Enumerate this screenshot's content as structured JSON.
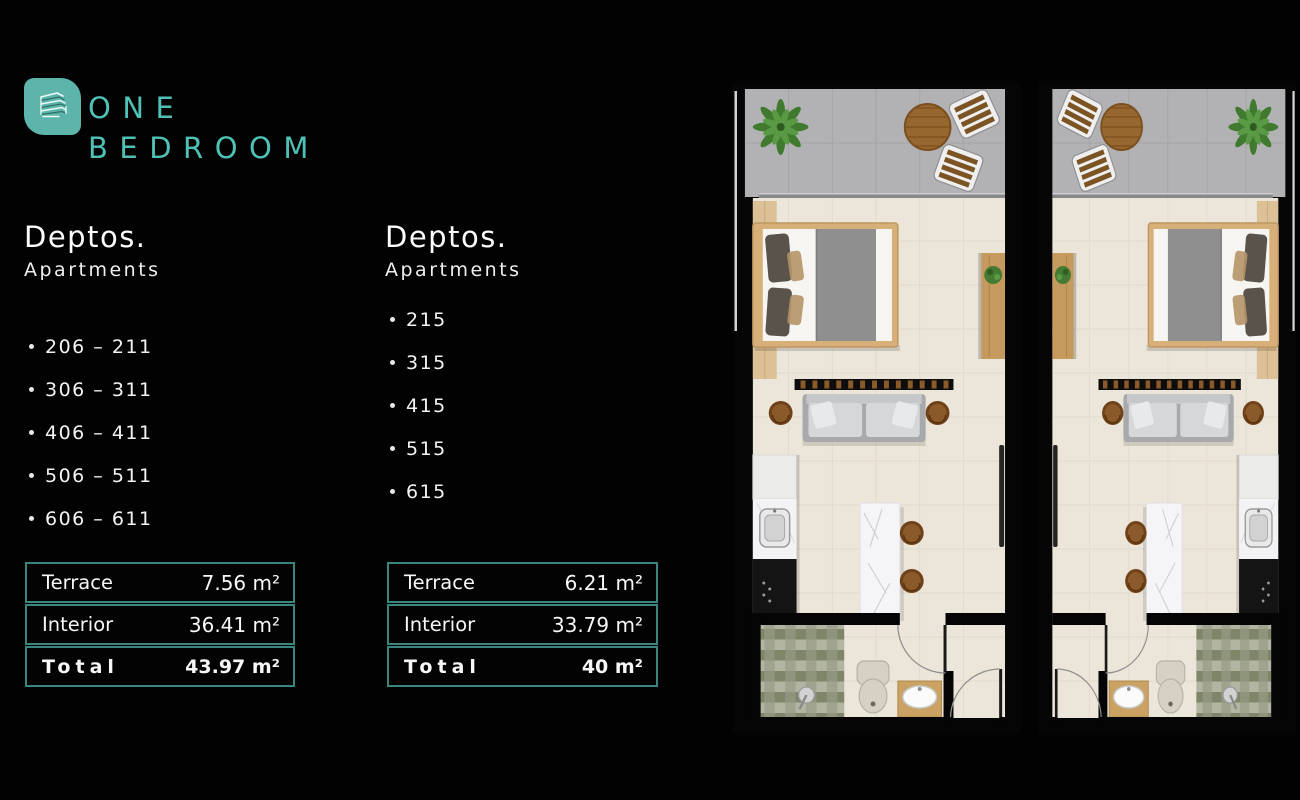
{
  "brand": {
    "logo_icon": "building-icon",
    "title_line1": "ONE",
    "title_line2": "BEDROOM"
  },
  "columns": [
    {
      "heading": "Deptos.",
      "subheading": "Apartments",
      "items": [
        "206 – 211",
        "306 – 311",
        "406 – 411",
        "506 – 511",
        "606 – 611"
      ],
      "table": [
        {
          "label": "Terrace",
          "value": "7.56 m²"
        },
        {
          "label": "Interior",
          "value": "36.41 m²"
        },
        {
          "label": "Total",
          "value": "43.97 m²"
        }
      ]
    },
    {
      "heading": "Deptos.",
      "subheading": "Apartments",
      "items": [
        "215",
        "315",
        "415",
        "515",
        "615"
      ],
      "table": [
        {
          "label": "Terrace",
          "value": "6.21 m²"
        },
        {
          "label": "Interior",
          "value": "33.79 m²"
        },
        {
          "label": "Total",
          "value": "40 m²"
        }
      ]
    }
  ],
  "floor_plans": {
    "left": "one-bedroom-unit-floor-plan",
    "right": "one-bedroom-unit-floor-plan-mirrored"
  },
  "colors": {
    "background": "#020202",
    "accent_teal": "#4fc1b6",
    "logo_teal": "#5cb4aa",
    "table_border": "#3a867f",
    "terrace_tile": "#b2b2b4",
    "interior_floor": "#ece6da"
  }
}
